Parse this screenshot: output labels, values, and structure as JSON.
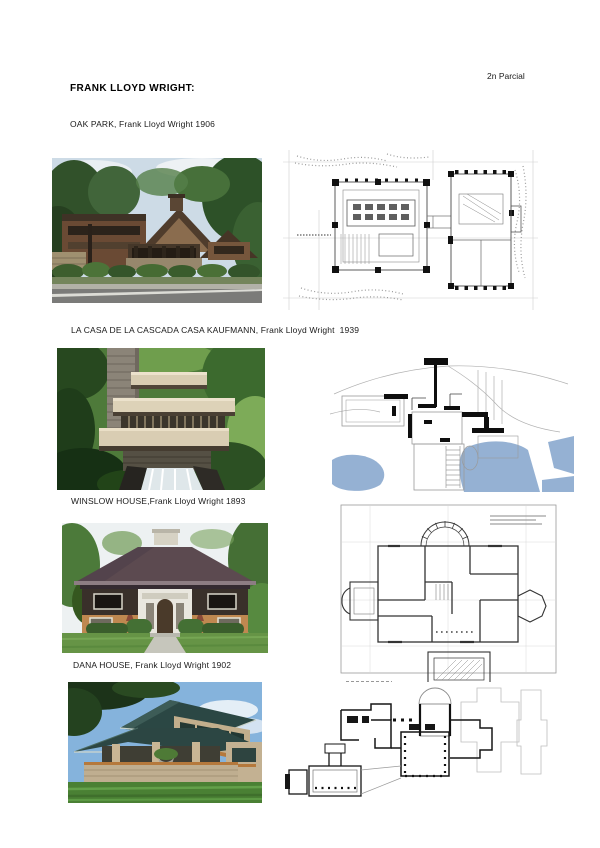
{
  "page": {
    "corner_note": "2n Parcial",
    "title": "FRANK LLOYD WRIGHT:"
  },
  "sections": [
    {
      "id": "oak-park",
      "caption": "OAK PARK, Frank Lloyd Wright 1906"
    },
    {
      "id": "casa-kaufmann",
      "caption": "LA CASA DE LA CASCADA CASA KAUFMANN, Frank Lloyd Wright  1939"
    },
    {
      "id": "winslow-house",
      "caption": "WINSLOW HOUSE,Frank Lloyd Wright 1893"
    },
    {
      "id": "dana-house",
      "caption": "DANA HOUSE, Frank Lloyd Wright 1902"
    }
  ],
  "colors": {
    "plan_water": "#95b1d3",
    "page_background": "#ffffff"
  }
}
